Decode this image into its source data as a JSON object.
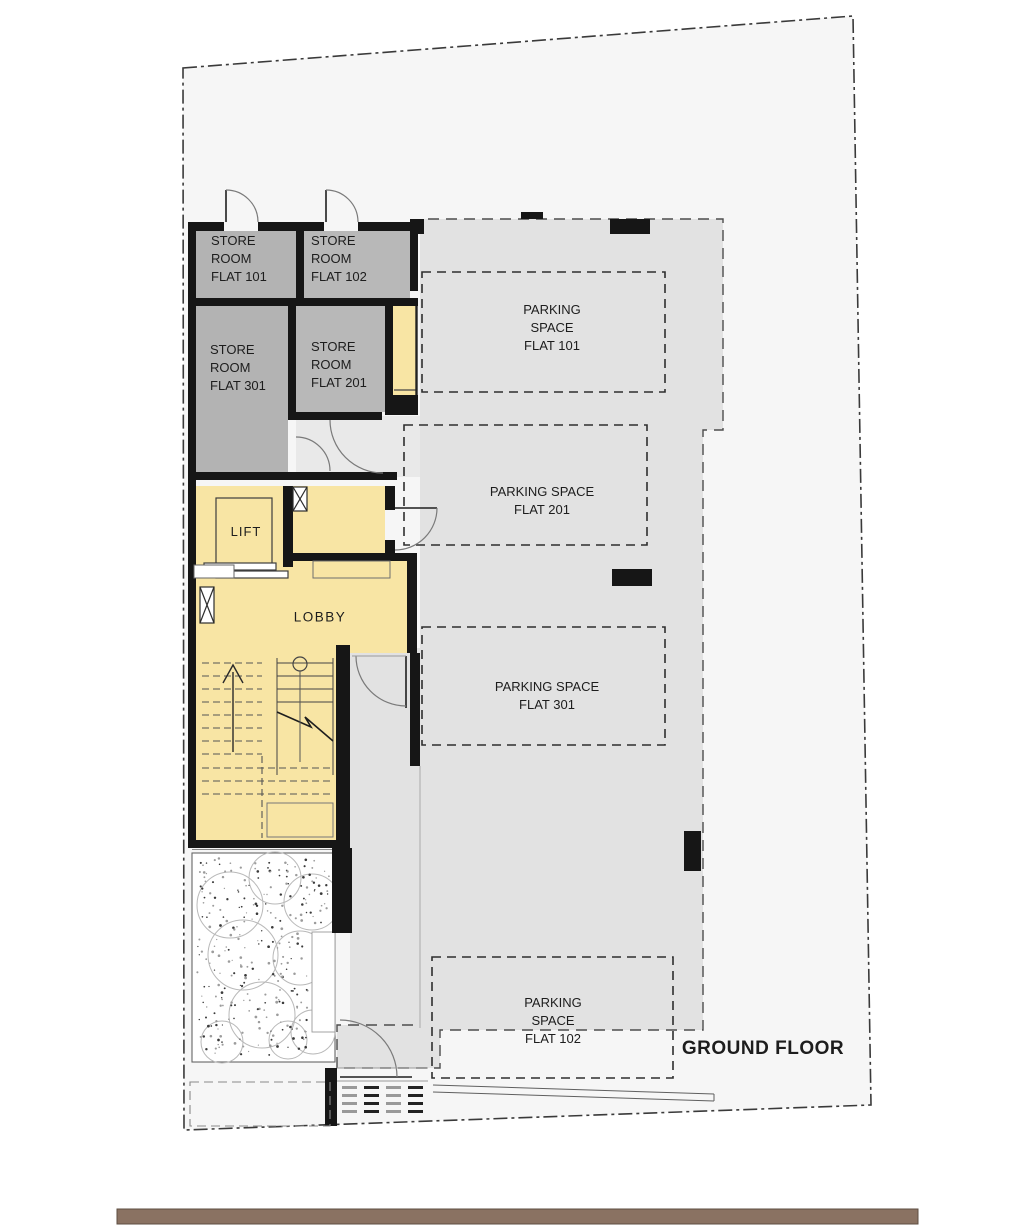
{
  "title": "GROUND FLOOR",
  "rooms": {
    "store_101": {
      "label": "STORE\nROOM\nFLAT 101"
    },
    "store_102": {
      "label": "STORE\nROOM\nFLAT 102"
    },
    "store_301": {
      "label": "STORE\nROOM\nFLAT 301"
    },
    "store_201": {
      "label": "STORE\nROOM\nFLAT 201"
    },
    "lift": {
      "label": "LIFT"
    },
    "lobby": {
      "label": "LOBBY"
    }
  },
  "parking": {
    "flat_101": {
      "label": "PARKING\nSPACE\nFLAT 101"
    },
    "flat_201": {
      "label": "PARKING SPACE\nFLAT 201"
    },
    "flat_301": {
      "label": "PARKING SPACE\nFLAT 301"
    },
    "flat_102": {
      "label": "PARKING\nSPACE\nFLAT 102"
    }
  },
  "colors": {
    "wall": "#161616",
    "store_fill": "#b3b3b3",
    "parking_fill": "#e2e2e2",
    "hallway_fill": "#e9e9e9",
    "lobby_fill": "#f8e5a4",
    "site_fill": "#f6f6f6",
    "footer_bar": "#8a7262"
  }
}
